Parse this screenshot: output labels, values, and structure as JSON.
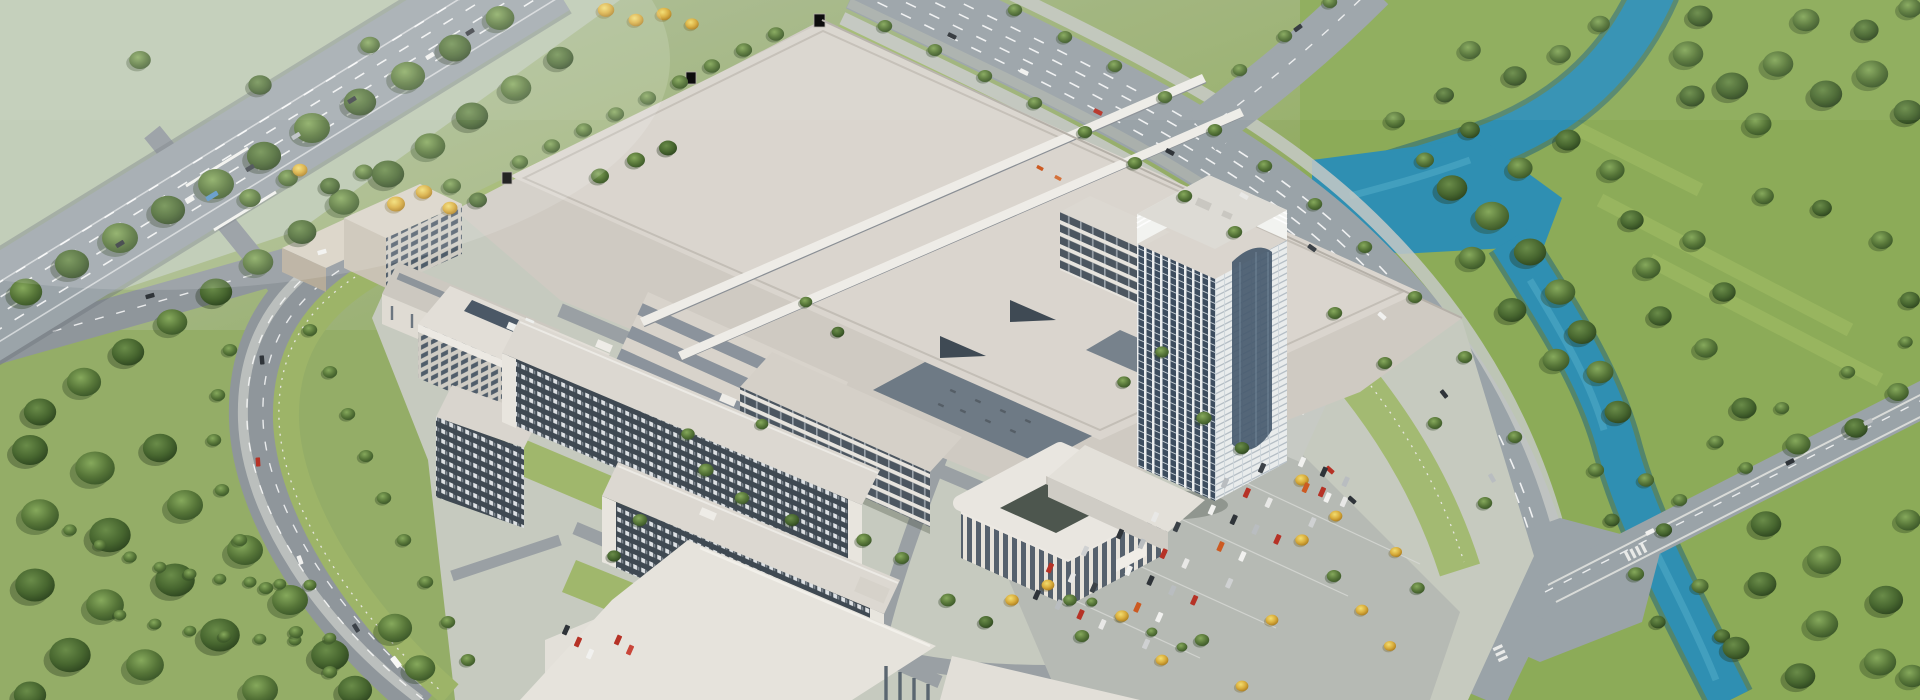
{
  "scene": {
    "title": "Aerial rendering of a manufacturing campus",
    "description": "Photorealistic aerial rendering of a large corporate manufacturing campus: a huge white factory hall with lower production halls, a white high-rise office tower with a curved crown, a rounded office podium with courtyard, two long dormitory slabs with dense window grids, a multi-storey parking structure, surface parking lots with yellow autumn trees, a highway overpass in the north-west, tree-lined boulevards, a south-east road intersection with a bridge, a turquoise river winding through bright green meadows and dense tree clusters on the east side, and a wooded park in the south-west.",
    "elements": [
      "hazy-farm-field",
      "highway-overpass",
      "slip-road",
      "west-boulevard",
      "northeast-arterial-road",
      "arterial-fork",
      "east-bridge-road",
      "road-intersection",
      "river",
      "east-meadow",
      "southwest-park",
      "campus-grounds",
      "factory-hall",
      "low-production-halls",
      "sawtooth-roof-hall",
      "rooftop-walkway-bridges",
      "parking-garage",
      "dormitory-slab",
      "dormitory-block",
      "warehouse",
      "staff-dormitory",
      "lab-building",
      "atrium-office-building",
      "canteen-building",
      "service-building",
      "office-podium",
      "office-tower",
      "surface-parking-lot",
      "parked-cars",
      "road-vehicles",
      "tree-clusters",
      "yellow-trees"
    ]
  },
  "palette": {
    "haze_field": "#b9c6ae",
    "meadow": "#8cab58",
    "lawn": "#9fb96f",
    "forest_dark": "#3a5628",
    "tree_green": "#55753a",
    "tree_yellow": "#ddb13f",
    "river": "#2f8fb2",
    "road": "#9aa0a5",
    "sidewalk": "#c3c7c3",
    "factory_roof": "#dad5ce",
    "dark_roof": "#6e7a85",
    "facade": "#e9e6e0",
    "glass": "#46586a",
    "car_red": "#b63226",
    "car_dark": "#2e3236",
    "car_white": "#f2f2f0"
  }
}
